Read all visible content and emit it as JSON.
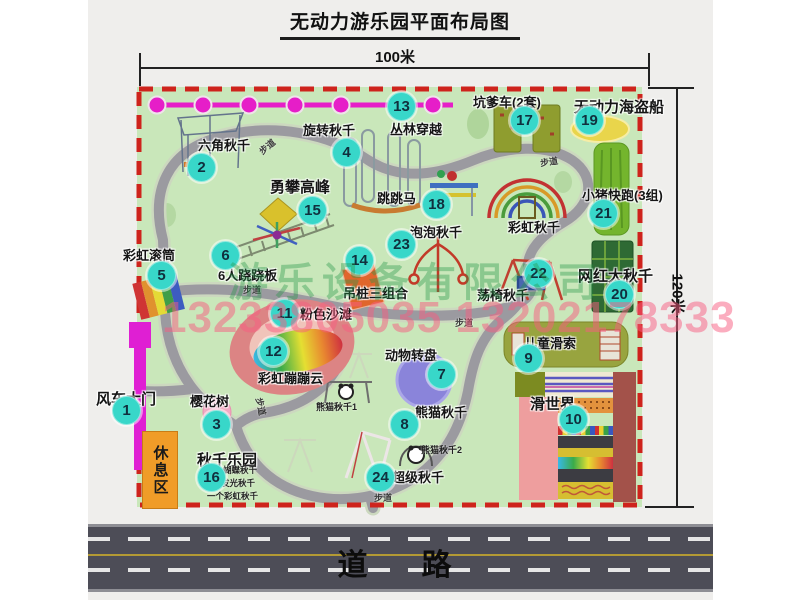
{
  "title": "无动力游乐园平面布局图",
  "dimensions": {
    "width": "100米",
    "height": "120米"
  },
  "road": {
    "label": "道　路"
  },
  "watermark": {
    "company": "游乐设备有限公司",
    "phone": "13233805035 13202178333"
  },
  "rest_area": {
    "label": "休息区"
  },
  "path_label": "步道",
  "rainbow_swing_label": "彩虹秋千",
  "panda_swing_sub1": "熊猫秋千1",
  "panda_swing_sub2": "熊猫秋千2",
  "swing_park_notes": [
    "两个蝴蝶秋千",
    "两个发光秋千",
    "一个彩虹秋千"
  ],
  "attractions": [
    {
      "num": 1,
      "label": "风车大门"
    },
    {
      "num": 2,
      "label": "六角秋千"
    },
    {
      "num": 3,
      "label": "樱花树"
    },
    {
      "num": 4,
      "label": "旋转秋千"
    },
    {
      "num": 5,
      "label": "彩虹滚筒"
    },
    {
      "num": 6,
      "label": "6人跷跷板"
    },
    {
      "num": 7,
      "label": "动物转盘"
    },
    {
      "num": 8,
      "label": "熊猫秋千"
    },
    {
      "num": 9,
      "label": "儿童滑索"
    },
    {
      "num": 10,
      "label": "滑世界"
    },
    {
      "num": 11,
      "label": "粉色沙滩"
    },
    {
      "num": 12,
      "label": "彩虹蹦蹦云"
    },
    {
      "num": 13,
      "label": "丛林穿越"
    },
    {
      "num": 14,
      "label": "吊桩三组合"
    },
    {
      "num": 15,
      "label": "勇攀高峰"
    },
    {
      "num": 16,
      "label": "秋千乐园"
    },
    {
      "num": 17,
      "label": "坑爹车(2套)"
    },
    {
      "num": 18,
      "label": "跳跳马"
    },
    {
      "num": 19,
      "label": "无动力海盗船"
    },
    {
      "num": 20,
      "label": "网红大秋千"
    },
    {
      "num": 21,
      "label": "小猪快跑(3组)"
    },
    {
      "num": 22,
      "label": "荡椅秋千"
    },
    {
      "num": 23,
      "label": "泡泡秋千"
    },
    {
      "num": 24,
      "label": "超级秋千"
    }
  ]
}
